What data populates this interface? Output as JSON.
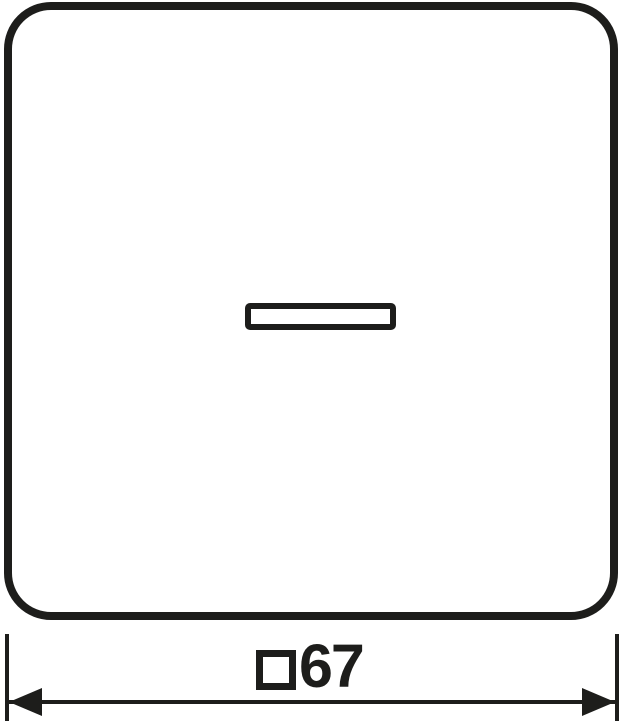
{
  "drawing": {
    "kind": "technical-line-drawing",
    "line_color": "#1d1d1b",
    "background_color": "#ffffff",
    "plate": {
      "shape": "rounded-square",
      "fill": "#ffffff"
    },
    "indicator_window": {
      "shape": "horizontal-rectangle",
      "fill": "#ffffff"
    },
    "dimension": {
      "symbol": "□",
      "value": "67",
      "label": "□67"
    }
  }
}
